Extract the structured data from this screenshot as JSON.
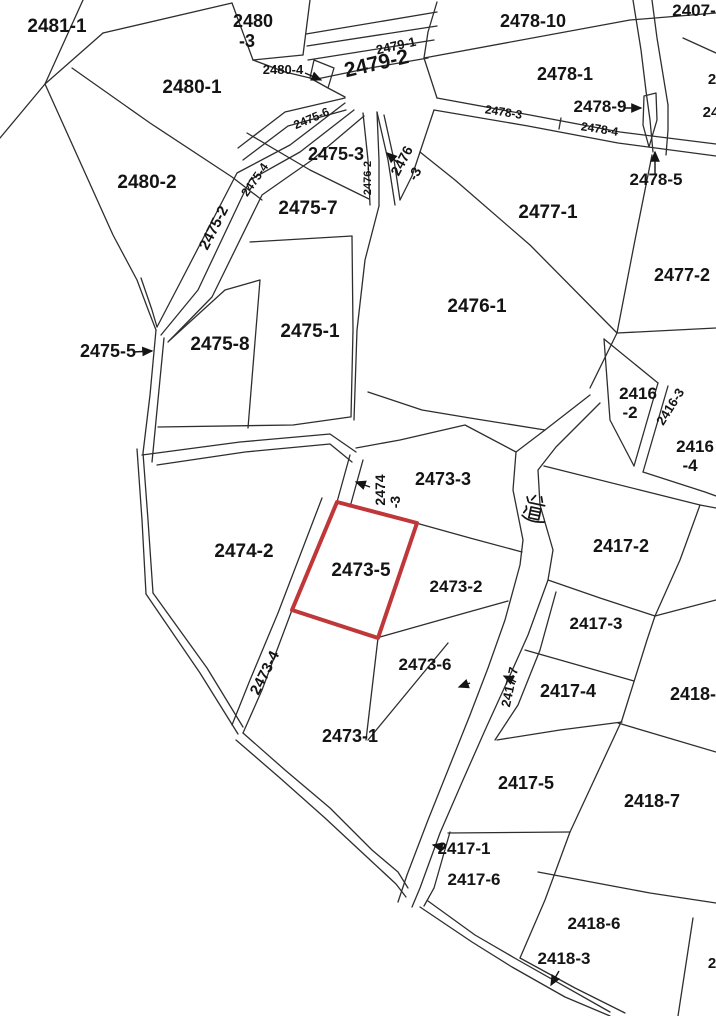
{
  "map": {
    "title": "cadastral-parcel-map",
    "background": "#ffffff",
    "line_color": "#2e2e2e",
    "text_color": "#141414",
    "highlight_color": "#c0373a",
    "road_label": "道",
    "highlight_parcel": {
      "id": "2473-5",
      "points": "337,502 417,523 378,638 292,610"
    },
    "labels": [
      {
        "id": "2481-1",
        "text": "2481-1",
        "x": 57,
        "y": 32,
        "rot": 0,
        "fs": 19
      },
      {
        "id": "2480-3",
        "text": "2480",
        "x": 253,
        "y": 27,
        "rot": 0,
        "fs": 18
      },
      {
        "id": "2480-3",
        "text": "-3",
        "x": 247,
        "y": 47,
        "rot": 0,
        "fs": 18
      },
      {
        "id": "2480-1",
        "text": "2480-1",
        "x": 192,
        "y": 93,
        "rot": 0,
        "fs": 19
      },
      {
        "id": "2480-4",
        "text": "2480-4",
        "x": 283,
        "y": 74,
        "rot": 0,
        "fs": 13
      },
      {
        "id": "2480-2",
        "text": "2480-2",
        "x": 147,
        "y": 188,
        "rot": 0,
        "fs": 19
      },
      {
        "id": "2479-1",
        "text": "2479-1",
        "x": 397,
        "y": 50,
        "rot": -13,
        "fs": 13
      },
      {
        "id": "2479-2",
        "text": "2479-2",
        "x": 378,
        "y": 70,
        "rot": -13,
        "fs": 21
      },
      {
        "id": "2478-10",
        "text": "2478-10",
        "x": 533,
        "y": 27,
        "rot": 0,
        "fs": 18
      },
      {
        "id": "2478-1",
        "text": "2478-1",
        "x": 565,
        "y": 80,
        "rot": 0,
        "fs": 18
      },
      {
        "id": "2478-9",
        "text": "2478-9",
        "x": 600,
        "y": 112,
        "rot": 0,
        "fs": 17
      },
      {
        "id": "2478-3",
        "text": "2478-3",
        "x": 503,
        "y": 116,
        "rot": 9,
        "fs": 12
      },
      {
        "id": "2478-4",
        "text": "2478-4",
        "x": 599,
        "y": 133,
        "rot": 9,
        "fs": 12
      },
      {
        "id": "2478-5",
        "text": "2478-5",
        "x": 656,
        "y": 185,
        "rot": 0,
        "fs": 17
      },
      {
        "id": "2407",
        "text": "2407-",
        "x": 694,
        "y": 16,
        "rot": 0,
        "fs": 17
      },
      {
        "id": "edge-partial-a",
        "text": "2",
        "x": 712,
        "y": 84,
        "rot": 0,
        "fs": 15
      },
      {
        "id": "edge-partial-b",
        "text": "24",
        "x": 711,
        "y": 117,
        "rot": 0,
        "fs": 15
      },
      {
        "id": "2475-6",
        "text": "2475-6",
        "x": 313,
        "y": 122,
        "rot": -23,
        "fs": 12
      },
      {
        "id": "2475-3",
        "text": "2475-3",
        "x": 336,
        "y": 160,
        "rot": 0,
        "fs": 18
      },
      {
        "id": "2475-4",
        "text": "2475-4",
        "x": 258,
        "y": 182,
        "rot": -55,
        "fs": 12
      },
      {
        "id": "2475-2",
        "text": "2475-2",
        "x": 218,
        "y": 230,
        "rot": -63,
        "fs": 15
      },
      {
        "id": "2475-7",
        "text": "2475-7",
        "x": 308,
        "y": 214,
        "rot": 0,
        "fs": 19
      },
      {
        "id": "2476-2",
        "text": "2476-2",
        "x": 371,
        "y": 178,
        "rot": -90,
        "fs": 11
      },
      {
        "id": "2476-3",
        "text": "2476",
        "x": 406,
        "y": 163,
        "rot": -62,
        "fs": 14
      },
      {
        "id": "2476-3",
        "text": "-3",
        "x": 419,
        "y": 176,
        "rot": -62,
        "fs": 14
      },
      {
        "id": "2477-1",
        "text": "2477-1",
        "x": 548,
        "y": 218,
        "rot": 0,
        "fs": 19
      },
      {
        "id": "2477-2",
        "text": "2477-2",
        "x": 682,
        "y": 281,
        "rot": 0,
        "fs": 18
      },
      {
        "id": "2476-1",
        "text": "2476-1",
        "x": 477,
        "y": 312,
        "rot": 0,
        "fs": 19
      },
      {
        "id": "2475-5",
        "text": "2475-5",
        "x": 108,
        "y": 357,
        "rot": 0,
        "fs": 18
      },
      {
        "id": "2475-8",
        "text": "2475-8",
        "x": 220,
        "y": 350,
        "rot": 0,
        "fs": 19
      },
      {
        "id": "2475-1",
        "text": "2475-1",
        "x": 310,
        "y": 337,
        "rot": 0,
        "fs": 19
      },
      {
        "id": "2416-2",
        "text": "2416",
        "x": 638,
        "y": 399,
        "rot": 0,
        "fs": 17
      },
      {
        "id": "2416-2",
        "text": "-2",
        "x": 630,
        "y": 418,
        "rot": 0,
        "fs": 17
      },
      {
        "id": "2416-3",
        "text": "2416-3",
        "x": 674,
        "y": 409,
        "rot": -58,
        "fs": 13
      },
      {
        "id": "2416-4",
        "text": "2416",
        "x": 695,
        "y": 452,
        "rot": 0,
        "fs": 17
      },
      {
        "id": "2416-4",
        "text": "-4",
        "x": 690,
        "y": 471,
        "rot": 0,
        "fs": 17
      },
      {
        "id": "2474-3",
        "text": "2474",
        "x": 385,
        "y": 490,
        "rot": -90,
        "fs": 14
      },
      {
        "id": "2474-3",
        "text": "-3",
        "x": 400,
        "y": 502,
        "rot": -90,
        "fs": 14
      },
      {
        "id": "2473-3",
        "text": "2473-3",
        "x": 443,
        "y": 485,
        "rot": 0,
        "fs": 18
      },
      {
        "id": "road",
        "text": "",
        "x": 536,
        "y": 508,
        "rot": 12,
        "fs": 24
      },
      {
        "id": "2417-2",
        "text": "2417-2",
        "x": 621,
        "y": 552,
        "rot": 0,
        "fs": 18
      },
      {
        "id": "2474-2",
        "text": "2474-2",
        "x": 244,
        "y": 557,
        "rot": 0,
        "fs": 19
      },
      {
        "id": "2473-5",
        "text": "2473-5",
        "x": 361,
        "y": 576,
        "rot": 0,
        "fs": 19
      },
      {
        "id": "2473-2",
        "text": "2473-2",
        "x": 456,
        "y": 592,
        "rot": 0,
        "fs": 17
      },
      {
        "id": "2417-3",
        "text": "2417-3",
        "x": 596,
        "y": 629,
        "rot": 0,
        "fs": 17
      },
      {
        "id": "2473-4",
        "text": "2473-4",
        "x": 269,
        "y": 675,
        "rot": -63,
        "fs": 15
      },
      {
        "id": "2473-6",
        "text": "2473-6",
        "x": 425,
        "y": 670,
        "rot": 0,
        "fs": 17
      },
      {
        "id": "2417-7",
        "text": "2417-7",
        "x": 514,
        "y": 688,
        "rot": -78,
        "fs": 13
      },
      {
        "id": "2417-4",
        "text": "2417-4",
        "x": 568,
        "y": 697,
        "rot": 0,
        "fs": 18
      },
      {
        "id": "2418-1",
        "text": "2418-1",
        "x": 698,
        "y": 700,
        "rot": 0,
        "fs": 18
      },
      {
        "id": "2473-1",
        "text": "2473-1",
        "x": 350,
        "y": 742,
        "rot": 0,
        "fs": 18
      },
      {
        "id": "2417-5",
        "text": "2417-5",
        "x": 526,
        "y": 789,
        "rot": 0,
        "fs": 18
      },
      {
        "id": "2418-7",
        "text": "2418-7",
        "x": 652,
        "y": 807,
        "rot": 0,
        "fs": 18
      },
      {
        "id": "2417-1",
        "text": "2417-1",
        "x": 464,
        "y": 854,
        "rot": 0,
        "fs": 17
      },
      {
        "id": "2417-6",
        "text": "2417-6",
        "x": 474,
        "y": 885,
        "rot": 0,
        "fs": 17
      },
      {
        "id": "2418-6",
        "text": "2418-6",
        "x": 594,
        "y": 929,
        "rot": 0,
        "fs": 17
      },
      {
        "id": "2418-3",
        "text": "2418-3",
        "x": 564,
        "y": 964,
        "rot": 0,
        "fs": 17
      },
      {
        "id": "edge-partial-c",
        "text": "2",
        "x": 712,
        "y": 968,
        "rot": 0,
        "fs": 15
      }
    ],
    "arrows": [
      {
        "for": "2480-4",
        "x1": 305,
        "y1": 73,
        "x2": 321,
        "y2": 80
      },
      {
        "for": "2478-9",
        "x1": 624,
        "y1": 108,
        "x2": 641,
        "y2": 108
      },
      {
        "for": "2478-5",
        "x1": 655,
        "y1": 174,
        "x2": 655,
        "y2": 152
      },
      {
        "for": "2476-3",
        "x1": 398,
        "y1": 163,
        "x2": 387,
        "y2": 153
      },
      {
        "for": "2475-5",
        "x1": 133,
        "y1": 352,
        "x2": 152,
        "y2": 351
      },
      {
        "for": "2474-3",
        "x1": 370,
        "y1": 487,
        "x2": 356,
        "y2": 482
      },
      {
        "for": "2417-7",
        "x1": 516,
        "y1": 682,
        "x2": 504,
        "y2": 676
      },
      {
        "for": "road-mark",
        "x1": 470,
        "y1": 683,
        "x2": 459,
        "y2": 687
      },
      {
        "for": "2417-1",
        "x1": 446,
        "y1": 848,
        "x2": 433,
        "y2": 845
      },
      {
        "for": "2418-3",
        "x1": 559,
        "y1": 971,
        "x2": 551,
        "y2": 985
      }
    ]
  }
}
